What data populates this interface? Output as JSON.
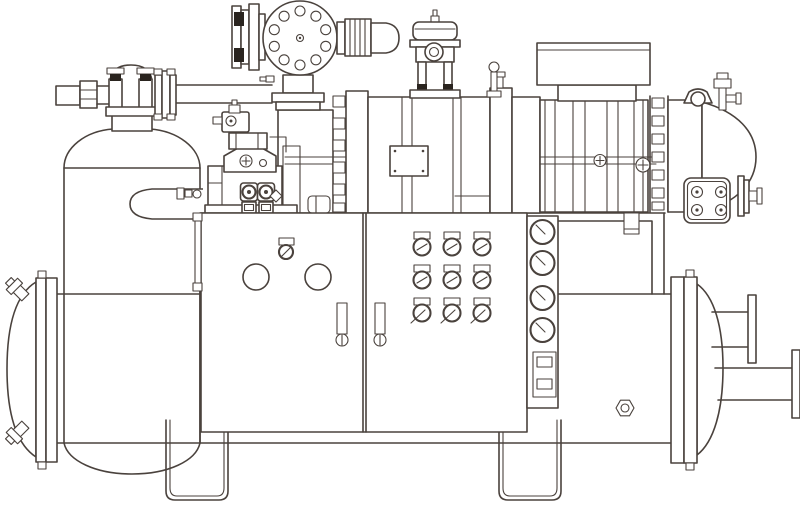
{
  "figure": {
    "type": "technical-line-drawing",
    "title": "Water-cooled screw chiller package — engineering line drawing",
    "description": "Monochrome technical illustration of an industrial screw-compressor chiller unit: a vertical oil separator tank with top shut-off valve and suction piping on the left, a bolted discharge flange with sight cover, a horizontal twin-screw compressor and drive motor with end cover on the right, a two-door control cabinet with two round knobs, a 3x3 grid of small valve gauges and a side strip of four round pressure gauges, all mounted above a horizontal shell-and-tube heat-exchanger vessel with dished heads, flanged water nozzles and two U-strap support feet.",
    "palette": {
      "background": "#ffffff",
      "line": "#4a423d",
      "dark_fill": "#2a241f"
    }
  },
  "components": {
    "heat_exchanger_vessel": "Horizontal shell-and-tube vessel with dished heads and end flanges",
    "left_nozzles": "Two angled fittings on the left dished head",
    "right_nozzles": "Upper and lower flanged water nozzles on the right head",
    "support_feet": "Two U-strap mounting feet under the vessel",
    "oil_separator_tank": "Vertical oil separator tank with domed top and dished bottom",
    "suction_valve": "Twin-post shut-off valve on tank neck with flange pack and long suction pipe",
    "discharge_flange": "Large round bolted flange cover with ten bolt holes and coupling",
    "oil_pump_assembly": "Oil pump block with two solenoid coil valves and pilot solenoid",
    "screw_compressor": "Ribbed twin-screw compressor casing with tie rods and nameplate",
    "drive_motor": "Motor barrel with terminal box, bolted flange ring and domed end cover",
    "motor_end_details": "Lifting lug, top service valve, four-bolt cover plate and shaft fittings",
    "top_actuator": "Small capacity-control actuator with sight port standing on the casing",
    "control_cabinet": "Two-door control cabinet with latch, knobs, door handles and gauge grid",
    "gauge_strip": "Narrow side panel with four round gauges and a terminal switch box",
    "down_pipe": "Discharge down-pipe from compressor to vessel shell",
    "hex_plug": "Hexagonal plug on the vessel shell"
  },
  "counts": {
    "flange_bolt_holes": 10,
    "door_knobs": 2,
    "gauge_grid_rows": 3,
    "gauge_grid_cols": 3,
    "side_gauges": 4,
    "end_plate_bolts": 4,
    "support_feet": 2,
    "solenoid_coils": 2
  }
}
